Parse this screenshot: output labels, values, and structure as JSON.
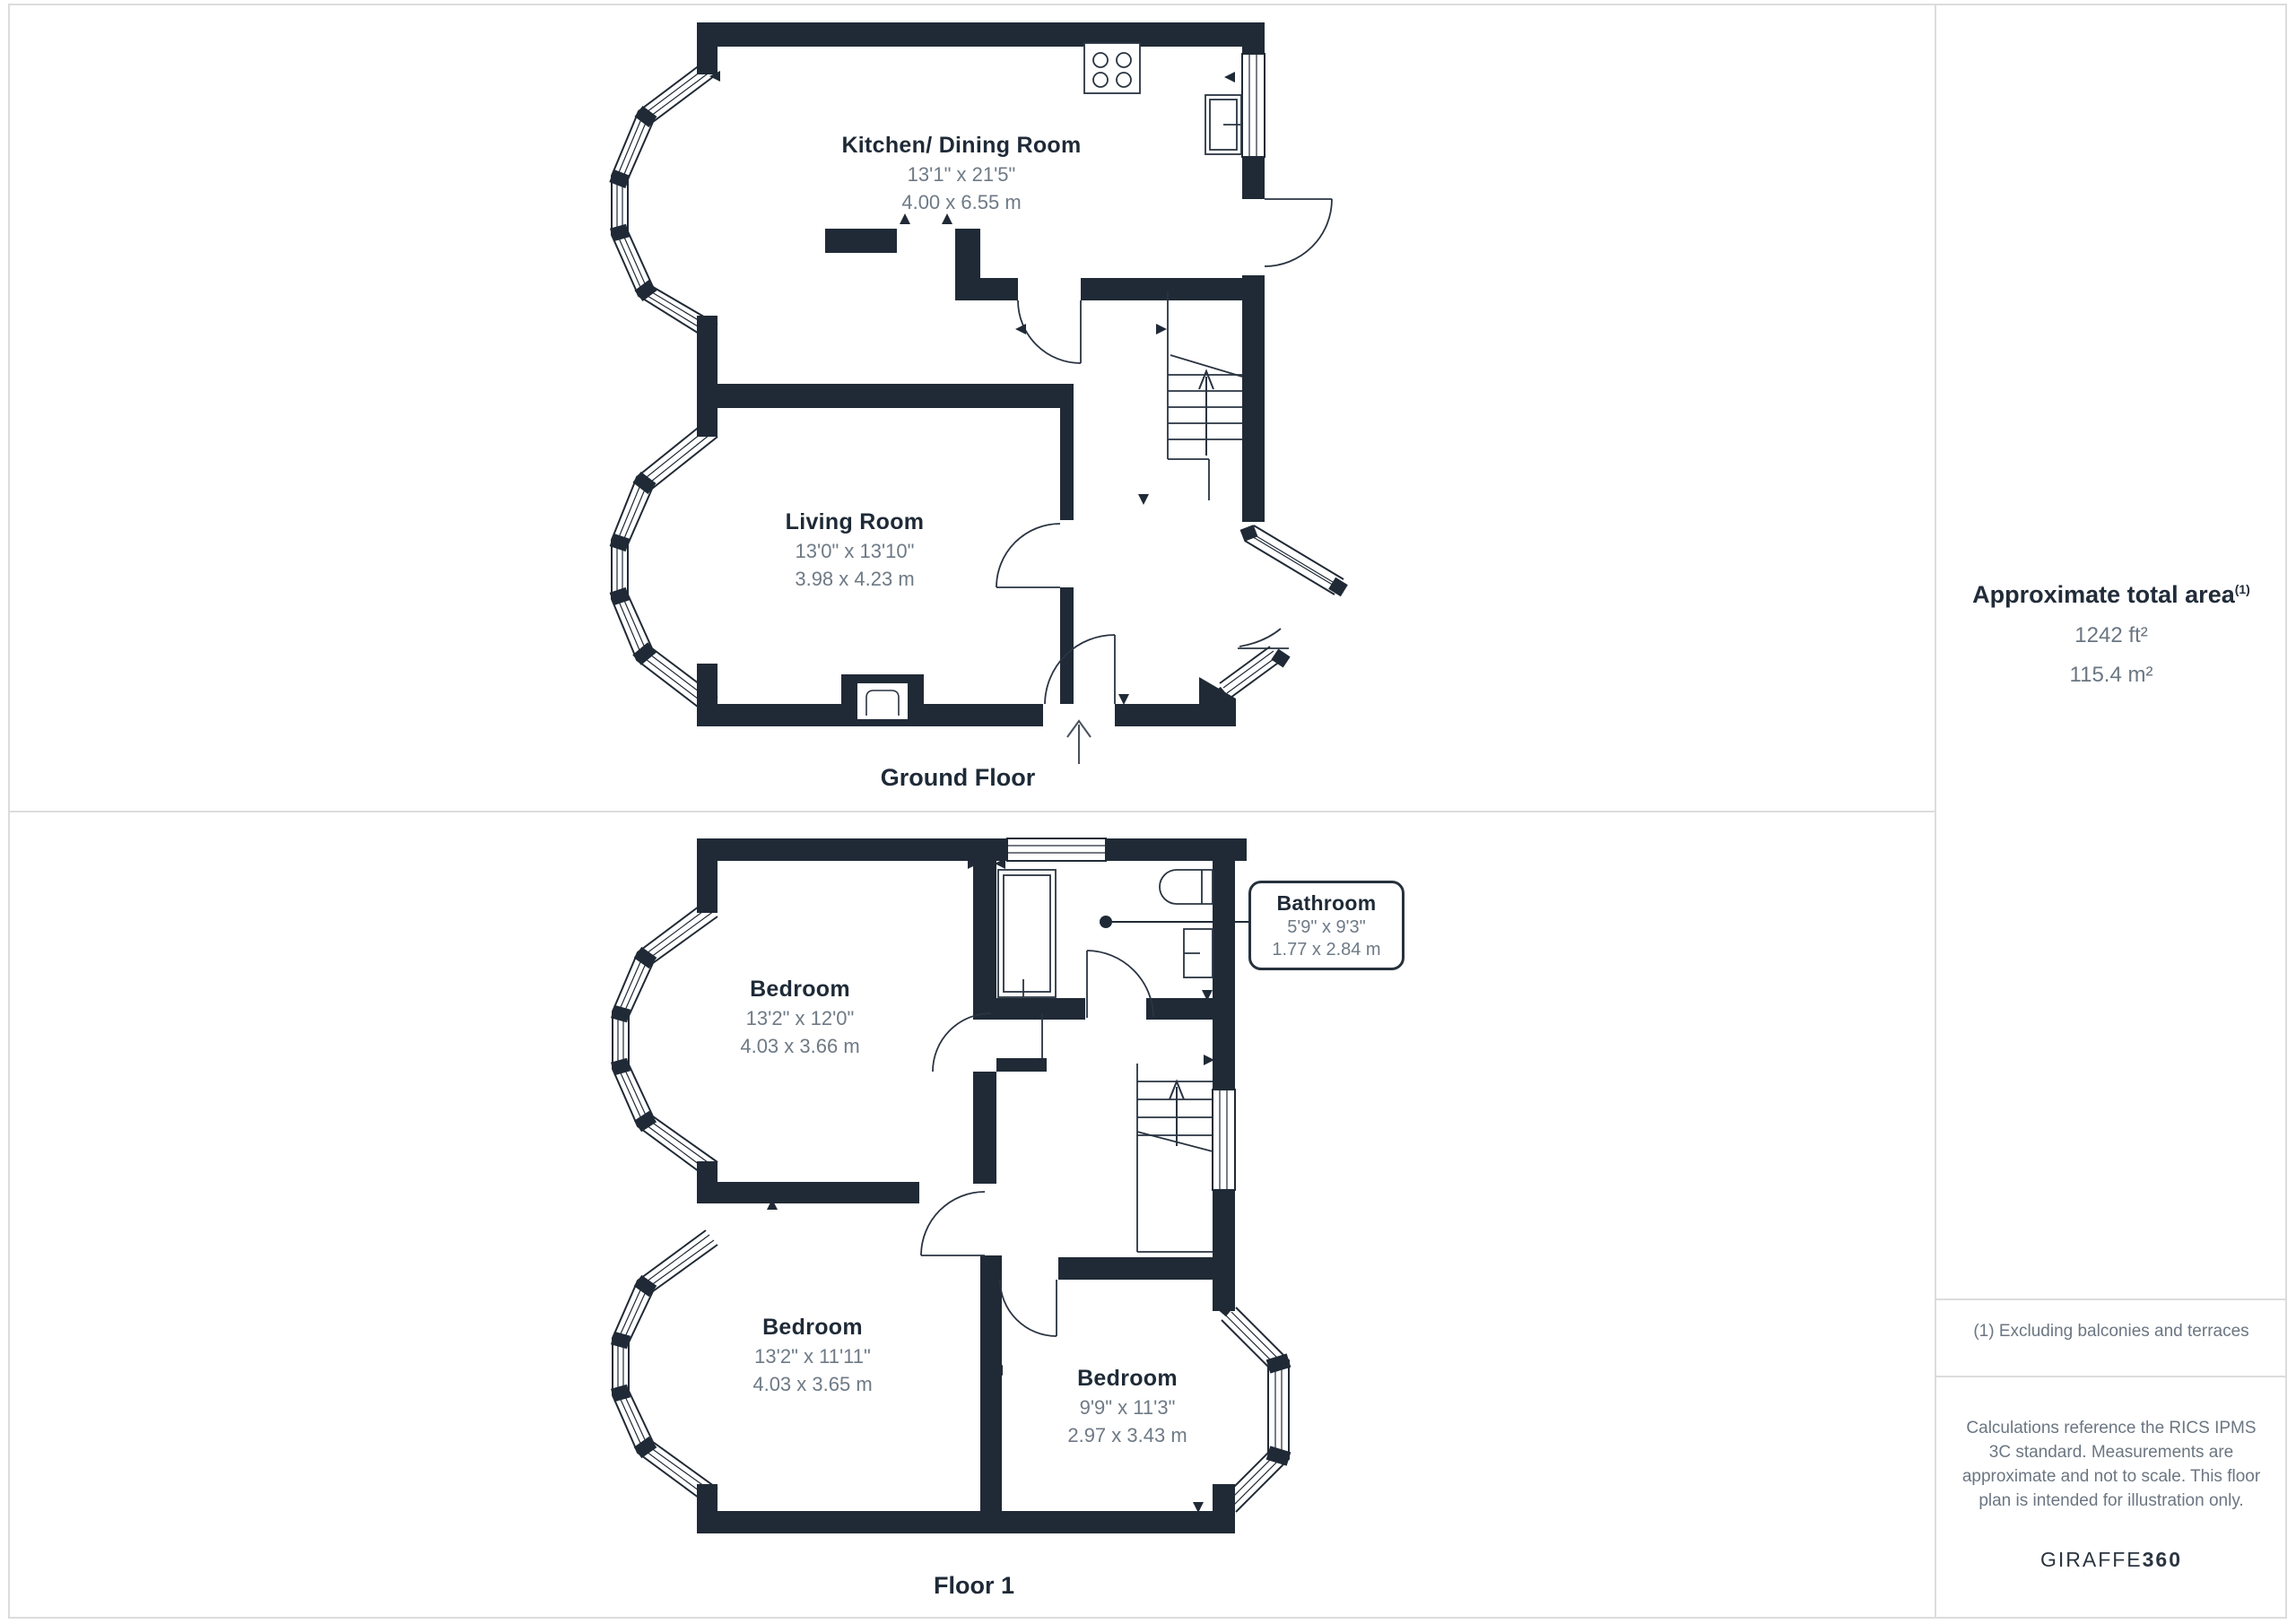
{
  "rooms": {
    "kitchen": {
      "name": "Kitchen/ Dining Room",
      "imperial": "13'1\" x 21'5\"",
      "metric": "4.00 x 6.55 m"
    },
    "living": {
      "name": "Living Room",
      "imperial": "13'0\" x 13'10\"",
      "metric": "3.98 x 4.23 m"
    },
    "bedroom1": {
      "name": "Bedroom",
      "imperial": "13'2\" x 12'0\"",
      "metric": "4.03 x 3.66 m"
    },
    "bedroom2": {
      "name": "Bedroom",
      "imperial": "13'2\" x 11'11\"",
      "metric": "4.03 x 3.65 m"
    },
    "bedroom3": {
      "name": "Bedroom",
      "imperial": "9'9\" x 11'3\"",
      "metric": "2.97 x 3.43 m"
    },
    "bathroom": {
      "name": "Bathroom",
      "imperial": "5'9\" x 9'3\"",
      "metric": "1.77 x 2.84 m"
    }
  },
  "floors": {
    "ground": "Ground Floor",
    "first": "Floor 1"
  },
  "sidebar": {
    "area_title": "Approximate total area",
    "area_sup": "(1)",
    "area_ft": "1242 ft²",
    "area_m": "115.4 m²",
    "note1": "(1) Excluding balconies and terraces",
    "note2": "Calculations reference the RICS IPMS 3C standard. Measurements are approximate and not to scale. This floor plan is intended for illustration only.",
    "logo_left": "GIRAFFE",
    "logo_right": "360"
  },
  "colors": {
    "wall": "#202a36",
    "dim_text": "#6e7a86",
    "divider": "#dcdcdc"
  }
}
